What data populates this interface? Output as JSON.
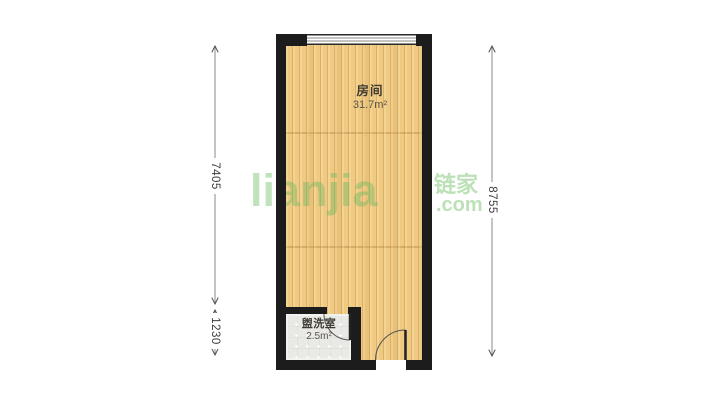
{
  "floor_plan": {
    "rooms": [
      {
        "id": "room",
        "name": "房间",
        "area": "31.7m²"
      },
      {
        "id": "washroom",
        "name": "盥洗室",
        "area": "2.5m²"
      }
    ],
    "dimensions": [
      {
        "id": "left-main",
        "value": "7405",
        "side": "left",
        "measures": "main room height"
      },
      {
        "id": "left-sub",
        "value": "1230",
        "side": "left",
        "measures": "washroom height"
      },
      {
        "id": "right",
        "value": "8755",
        "side": "right",
        "measures": "total height"
      }
    ],
    "colors": {
      "wall": "#1c1c1c",
      "wood_floor": "#f0ca81",
      "tile_floor": "#e9e9e5",
      "dimension_text": "#3c3c3c",
      "watermark_green": "#68ba60"
    }
  },
  "watermark": {
    "logo": "lianjia",
    "brand": "链家",
    "suffix": ".com"
  }
}
